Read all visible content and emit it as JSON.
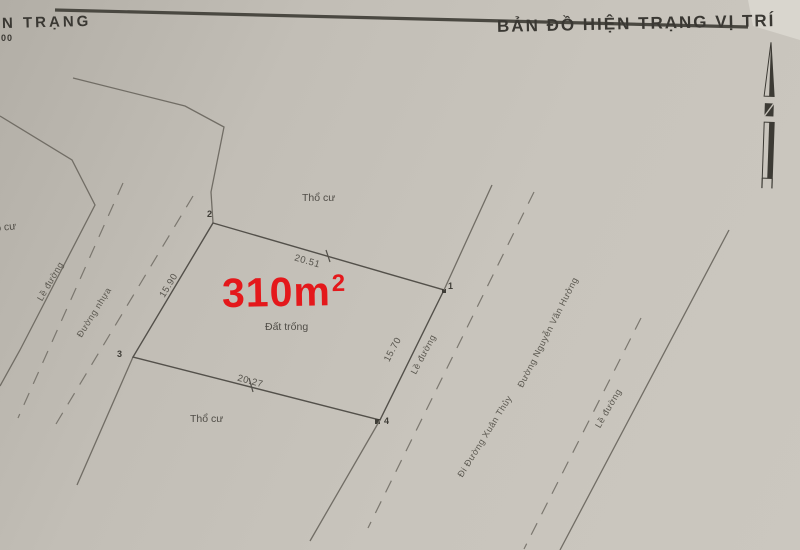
{
  "header": {
    "title_left": "N TRẠNG",
    "scale": "400",
    "title_right": "BẢN ĐỒ HIỆN TRẠNG VỊ TRÍ"
  },
  "parcel": {
    "area_value": "310m",
    "area_exponent": "2",
    "interior_label": "Đất trống",
    "vertices": {
      "v1": "1",
      "v2": "2",
      "v3": "3",
      "v4": "4"
    },
    "dimensions": {
      "top": "20.51",
      "left": "15.90",
      "right": "15.70",
      "bottom": "20.27"
    }
  },
  "land_labels": {
    "tho_cu_top": "Thổ cư",
    "tho_cu_left": "Thổ cư",
    "tho_cu_bottom": "Thổ cư"
  },
  "road_labels": {
    "le_duong_left": "Lề đường",
    "duong_nhua": "Đường nhựa",
    "le_duong_center": "Lề đường",
    "di_duong_xuan_thuy": "Đi Đường Xuân Thủy",
    "duong_nguyen_van_huong": "Đường Nguyễn Văn Hưởng",
    "le_duong_right": "Lề đường"
  },
  "colors": {
    "area_text": "#e4181b",
    "paper": "#c6c2ba",
    "ink": "#4c4a44"
  }
}
